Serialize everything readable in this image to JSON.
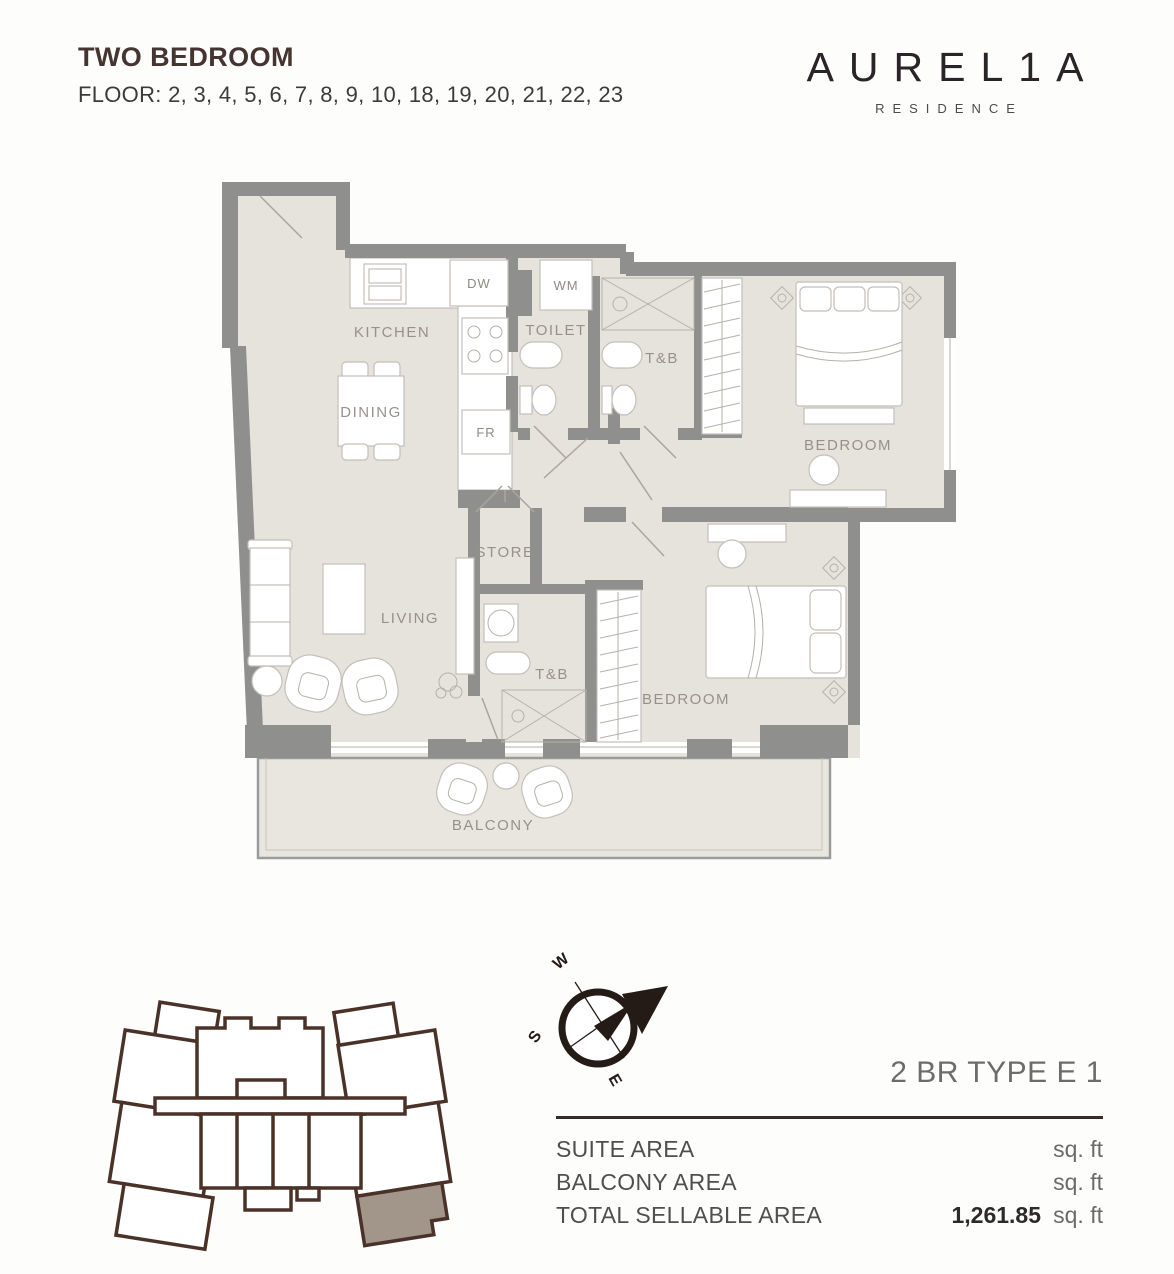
{
  "header": {
    "title": "TWO BEDROOM",
    "floor_line": "FLOOR: 2, 3, 4, 5, 6, 7, 8, 9, 10, 18, 19, 20, 21, 22, 23"
  },
  "brand": {
    "logo": "AUREL1A",
    "tagline": "RESIDENCE"
  },
  "floor_plan": {
    "rooms": {
      "kitchen": "KITCHEN",
      "dining": "DINING",
      "toilet": "TOILET",
      "tb_master": "T&B",
      "bedroom_master": "BEDROOM",
      "store": "STORE",
      "living": "LIVING",
      "tb_second": "T&B",
      "bedroom_second": "BEDROOM",
      "balcony": "BALCONY"
    },
    "appliances": {
      "dishwasher": "DW",
      "washing_machine": "WM",
      "fridge": "FR"
    }
  },
  "compass": {
    "n": "N",
    "s": "S",
    "e": "E",
    "w": "W"
  },
  "unit_info": {
    "type_label": "2 BR TYPE E 1",
    "rows": [
      {
        "label": "SUITE AREA",
        "value": "",
        "unit": "sq. ft"
      },
      {
        "label": "BALCONY AREA",
        "value": "",
        "unit": "sq. ft"
      },
      {
        "label": "TOTAL SELLABLE AREA",
        "value": "1,261.85",
        "unit": "sq. ft"
      }
    ]
  },
  "colors": {
    "accent_brown": "#453530",
    "keyplan_outline": "#4a3228",
    "keyplan_highlight": "#a2958a",
    "wall_gray": "#8f8f8d",
    "floor_beige": "#e6e2dc",
    "label_gray": "#96928b"
  }
}
